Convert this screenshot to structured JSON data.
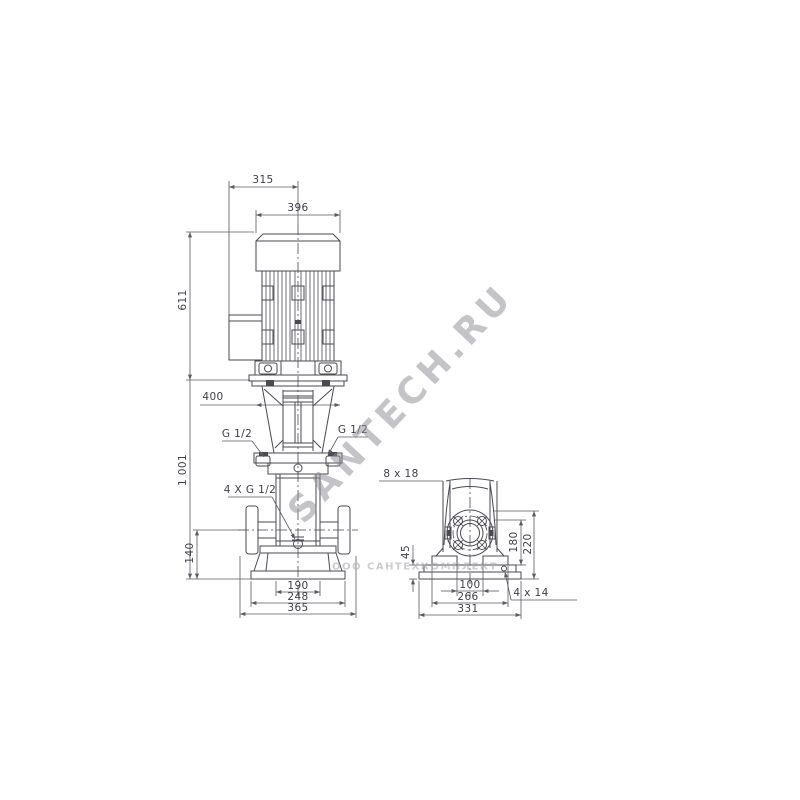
{
  "watermarks": {
    "diagonal": "SANTECH.RU",
    "horizontal": "ООО САНТЕХКОМПЛЕКТ"
  },
  "front": {
    "dim315": "315",
    "dim396": "396",
    "dim611": "611",
    "dim1001": "1 001",
    "dim400": "400",
    "portLeft": "G 1/2",
    "portRight": "G 1/2",
    "drainPlugs": "4 X G 1/2",
    "dim140": "140",
    "dim190": "190",
    "dim248": "248",
    "dim365": "365"
  },
  "side": {
    "flangeHoles": "8 x 18",
    "dim45": "45",
    "dim100": "100",
    "dim266": "266",
    "dim331": "331",
    "dim180": "180",
    "dim220": "220",
    "baseHoles": "4 x 14"
  },
  "colors": {
    "line": "#4a4a52",
    "dim": "#5a5a63",
    "watermark": "#8a8a92"
  }
}
